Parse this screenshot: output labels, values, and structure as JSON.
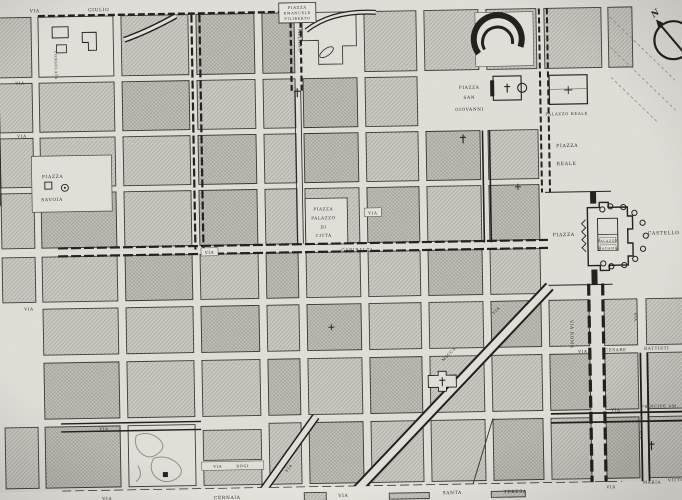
{
  "streets": {
    "generic_via": "VIA",
    "giulio": {
      "via": "VIA",
      "name": "GIULIO"
    },
    "milano": {
      "name": "MILANO"
    },
    "consolata": {
      "name": "CONSOLATA"
    },
    "garibaldi": {
      "via": "VIA",
      "name": "GARIBALDI"
    },
    "via_palazzo_di_citta": {
      "via": "VIA"
    },
    "roma": {
      "name": "VIA ROMA"
    },
    "cesare_battisti": {
      "via": "VIA",
      "first": "CESARE",
      "last": "BATTISTI"
    },
    "principe_amedeo": {
      "via": "VIA",
      "name": "PRINCIPE AM."
    },
    "maria_vittoria": {
      "via": "VIA",
      "first": "MARIA",
      "last": "VITTO."
    },
    "cernaia": {
      "via": "VIA",
      "name": "CERNAIA"
    },
    "santa_teresa": {
      "via": "VIA",
      "first": "SANTA",
      "last": "TERESA"
    },
    "bogino": {
      "via": "VIA",
      "name": "BOGI"
    },
    "pietro_micca": {
      "via": "VIA",
      "name": "MICCA"
    }
  },
  "squares": {
    "emanuele_filiberto": {
      "line1": "PIAZZA",
      "line2": "EMANUELE",
      "line3": "FILIBERTO"
    },
    "savoia": {
      "line1": "PIAZZA",
      "line2": "SAVOIA"
    },
    "san_giovanni": {
      "line1": "PIAZZA",
      "line2": "SAN",
      "line3": "GIOVANNI"
    },
    "reale": {
      "line1": "PIAZZA",
      "line2": "REALE"
    },
    "castello": {
      "line1": "PIAZZA",
      "line2": "CASTELLO"
    },
    "palazzo_di_citta": {
      "line1": "PIAZZA",
      "line2": "PALAZZO",
      "line3": "DI",
      "line4": "CITTÀ"
    }
  },
  "buildings": {
    "palazzo_reale": "PALAZZO REALE",
    "palazzo_madama": {
      "line1": "PALAZZO",
      "line2": "MADAMA"
    }
  },
  "compass": {
    "north_label": "N"
  },
  "colors": {
    "paper": "#e0ded7",
    "block": "#cbc9c2",
    "hatch": "#a6a39b",
    "ink": "#1d1c18"
  }
}
